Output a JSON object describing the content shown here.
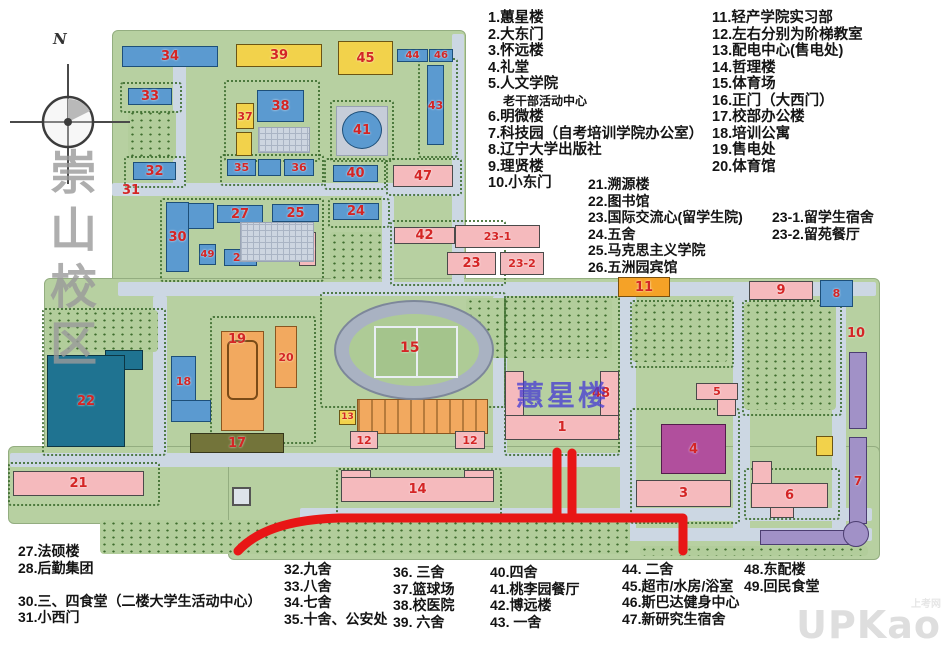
{
  "campus_label": "崇山校区",
  "compass_n": "N",
  "overlay": {
    "building_highlight": "蕙星楼",
    "route_color": "#e81616"
  },
  "watermark": {
    "main": "UPKao",
    "sub": "上考网"
  },
  "legend": {
    "tl": [
      "1.蕙星楼",
      "2.大东门",
      "3.怀远楼",
      "4.礼堂",
      "5.人文学院",
      "老干部活动中心",
      "6.明微楼",
      "7.科技园（自考培训学院办公室）",
      "8.辽宁大学出版社",
      "9.理贤楼",
      "10.小东门"
    ],
    "tr": [
      "11.轻产学院实习部",
      "12.左右分别为阶梯教室",
      "13.配电中心(售电处)",
      "14.哲理楼",
      "15.体育场",
      "16.正门（大西门）",
      "17.校部办公楼",
      "18.培训公寓",
      "19.售电处",
      "20.体育馆"
    ],
    "mid": [
      "21.溯源楼",
      "22.图书馆",
      "23.国际交流心(留学生院)",
      "24.五舍",
      "25.马克思主义学院",
      "26.五洲园宾馆"
    ],
    "mid2": [
      "23-1.留学生宿舍",
      "23-2.留苑餐厅"
    ],
    "b1": [
      "27.法硕楼",
      "28.后勤集团",
      "",
      "30.三、四食堂（二楼大学生活动中心）",
      "31.小西门"
    ],
    "b2": [
      "32.九舍",
      "33.八舍",
      "34.七舍",
      "35.十舍、公安处"
    ],
    "b3": [
      "36. 三舍",
      "37.篮球场",
      "38.校医院",
      "39. 六舍"
    ],
    "b4": [
      "40.四舍",
      "41.桃李园餐厅",
      "42.博远楼",
      "43. 一舍"
    ],
    "b5": [
      "44. 二舍",
      "45.超市/水房/浴室",
      "46.斯巴达健身中心",
      "47.新研究生宿舍"
    ],
    "b6": [
      "48.东配楼",
      "49.回民食堂"
    ]
  },
  "map": {
    "base": [
      {
        "x": 112,
        "y": 30,
        "w": 352,
        "h": 262
      },
      {
        "x": 44,
        "y": 278,
        "w": 834,
        "h": 192
      },
      {
        "x": 8,
        "y": 446,
        "w": 222,
        "h": 76
      },
      {
        "x": 228,
        "y": 446,
        "w": 650,
        "h": 112
      }
    ],
    "roads": [
      {
        "x": 112,
        "y": 183,
        "w": 350,
        "h": 13
      },
      {
        "x": 173,
        "y": 58,
        "w": 13,
        "h": 138
      },
      {
        "x": 452,
        "y": 34,
        "w": 12,
        "h": 258
      },
      {
        "x": 118,
        "y": 282,
        "w": 758,
        "h": 14
      },
      {
        "x": 153,
        "y": 296,
        "w": 14,
        "h": 166
      },
      {
        "x": 382,
        "y": 196,
        "w": 12,
        "h": 92
      },
      {
        "x": 493,
        "y": 296,
        "w": 14,
        "h": 166
      },
      {
        "x": 620,
        "y": 296,
        "w": 16,
        "h": 240
      },
      {
        "x": 733,
        "y": 296,
        "w": 17,
        "h": 236
      },
      {
        "x": 832,
        "y": 296,
        "w": 14,
        "h": 236
      },
      {
        "x": 10,
        "y": 453,
        "w": 612,
        "h": 14
      },
      {
        "x": 300,
        "y": 508,
        "w": 572,
        "h": 13
      },
      {
        "x": 618,
        "y": 528,
        "w": 254,
        "h": 13
      }
    ],
    "parks": [
      {
        "x": 466,
        "y": 298,
        "w": 146,
        "h": 60
      },
      {
        "x": 632,
        "y": 302,
        "w": 96,
        "h": 60
      },
      {
        "x": 744,
        "y": 302,
        "w": 92,
        "h": 108
      },
      {
        "x": 128,
        "y": 110,
        "w": 48,
        "h": 50
      },
      {
        "x": 330,
        "y": 232,
        "w": 52,
        "h": 48
      },
      {
        "x": 100,
        "y": 520,
        "w": 530,
        "h": 34
      },
      {
        "x": 640,
        "y": 546,
        "w": 228,
        "h": 10
      },
      {
        "x": 46,
        "y": 310,
        "w": 112,
        "h": 42
      }
    ],
    "blocks": [
      {
        "x": 120,
        "y": 82,
        "w": 58,
        "h": 27
      },
      {
        "x": 224,
        "y": 80,
        "w": 92,
        "h": 78
      },
      {
        "x": 330,
        "y": 100,
        "w": 60,
        "h": 58
      },
      {
        "x": 418,
        "y": 58,
        "w": 36,
        "h": 96
      },
      {
        "x": 124,
        "y": 156,
        "w": 58,
        "h": 28
      },
      {
        "x": 220,
        "y": 154,
        "w": 100,
        "h": 28
      },
      {
        "x": 324,
        "y": 158,
        "w": 58,
        "h": 28
      },
      {
        "x": 386,
        "y": 158,
        "w": 72,
        "h": 34
      },
      {
        "x": 160,
        "y": 198,
        "w": 160,
        "h": 80
      },
      {
        "x": 328,
        "y": 198,
        "w": 58,
        "h": 26
      },
      {
        "x": 390,
        "y": 220,
        "w": 112,
        "h": 62
      },
      {
        "x": 320,
        "y": 292,
        "w": 182,
        "h": 112
      },
      {
        "x": 210,
        "y": 316,
        "w": 102,
        "h": 124
      },
      {
        "x": 42,
        "y": 308,
        "w": 120,
        "h": 144
      },
      {
        "x": 336,
        "y": 468,
        "w": 162,
        "h": 44
      },
      {
        "x": 8,
        "y": 462,
        "w": 148,
        "h": 40
      },
      {
        "x": 504,
        "y": 296,
        "w": 112,
        "h": 156
      },
      {
        "x": 630,
        "y": 300,
        "w": 100,
        "h": 64
      },
      {
        "x": 742,
        "y": 300,
        "w": 96,
        "h": 112
      },
      {
        "x": 630,
        "y": 408,
        "w": 106,
        "h": 112
      },
      {
        "x": 744,
        "y": 468,
        "w": 92,
        "h": 48
      }
    ],
    "buildings": [
      {
        "n": "34",
        "x": 122,
        "y": 46,
        "w": 96,
        "h": 21,
        "c": "blue"
      },
      {
        "n": "39",
        "x": 236,
        "y": 44,
        "w": 86,
        "h": 23,
        "c": "yellow"
      },
      {
        "n": "45",
        "x": 338,
        "y": 41,
        "w": 55,
        "h": 34,
        "c": "yellow"
      },
      {
        "n": "44",
        "x": 397,
        "y": 49,
        "w": 31,
        "h": 13,
        "c": "blue",
        "fs": 10
      },
      {
        "n": "46",
        "x": 429,
        "y": 49,
        "w": 24,
        "h": 13,
        "c": "blue",
        "fs": 10
      },
      {
        "n": "33",
        "x": 128,
        "y": 88,
        "w": 44,
        "h": 17,
        "c": "blue"
      },
      {
        "n": "37",
        "x": 236,
        "y": 103,
        "w": 18,
        "h": 26,
        "c": "yellow",
        "fs": 11
      },
      {
        "n": "38",
        "x": 257,
        "y": 90,
        "w": 47,
        "h": 32,
        "c": "blue"
      },
      {
        "x": 236,
        "y": 132,
        "w": 16,
        "h": 24,
        "c": "yellow"
      },
      {
        "x": 258,
        "y": 127,
        "w": 52,
        "h": 26,
        "c": "court"
      },
      {
        "n": "35",
        "x": 227,
        "y": 159,
        "w": 29,
        "h": 17,
        "c": "blue",
        "fs": 11
      },
      {
        "x": 258,
        "y": 159,
        "w": 23,
        "h": 17,
        "c": "blue"
      },
      {
        "n": "36",
        "x": 284,
        "y": 159,
        "w": 30,
        "h": 17,
        "c": "blue",
        "fs": 11
      },
      {
        "n": "32",
        "x": 133,
        "y": 162,
        "w": 43,
        "h": 18,
        "c": "blue"
      },
      {
        "x": 336,
        "y": 106,
        "w": 52,
        "h": 50,
        "c": "gray"
      },
      {
        "n": "41",
        "x": 342,
        "y": 111,
        "w": 40,
        "h": 38,
        "c": "blue",
        "r": "50%"
      },
      {
        "n": "43",
        "x": 427,
        "y": 65,
        "w": 17,
        "h": 80,
        "c": "blue",
        "fs": 11
      },
      {
        "n": "40",
        "x": 333,
        "y": 165,
        "w": 45,
        "h": 17,
        "c": "blue"
      },
      {
        "n": "47",
        "x": 393,
        "y": 165,
        "w": 60,
        "h": 22,
        "c": "pink"
      },
      {
        "n": "30",
        "x": 166,
        "y": 202,
        "w": 23,
        "h": 70,
        "c": "blue"
      },
      {
        "x": 188,
        "y": 203,
        "w": 26,
        "h": 26,
        "c": "blue"
      },
      {
        "n": "27",
        "x": 217,
        "y": 205,
        "w": 46,
        "h": 18,
        "c": "blue"
      },
      {
        "n": "25",
        "x": 272,
        "y": 204,
        "w": 47,
        "h": 18,
        "c": "blue"
      },
      {
        "n": "24",
        "x": 333,
        "y": 203,
        "w": 46,
        "h": 17,
        "c": "blue"
      },
      {
        "n": "49",
        "x": 199,
        "y": 244,
        "w": 17,
        "h": 21,
        "c": "blue",
        "fs": 10
      },
      {
        "n": "28",
        "x": 224,
        "y": 249,
        "w": 33,
        "h": 17,
        "c": "blue",
        "fs": 11
      },
      {
        "n": "26",
        "x": 299,
        "y": 232,
        "w": 17,
        "h": 34,
        "c": "pink",
        "fs": 10
      },
      {
        "x": 240,
        "y": 222,
        "w": 74,
        "h": 40,
        "c": "court"
      },
      {
        "n": "42",
        "x": 394,
        "y": 227,
        "w": 61,
        "h": 17,
        "c": "pink"
      },
      {
        "n": "23-1",
        "x": 455,
        "y": 225,
        "w": 85,
        "h": 23,
        "c": "pink",
        "fs": 11
      },
      {
        "n": "23",
        "x": 447,
        "y": 252,
        "w": 49,
        "h": 23,
        "c": "pink"
      },
      {
        "n": "23-2",
        "x": 500,
        "y": 252,
        "w": 44,
        "h": 23,
        "c": "pink",
        "fs": 11
      },
      {
        "n": "11",
        "x": 618,
        "y": 277,
        "w": 52,
        "h": 20,
        "c": "orange2"
      },
      {
        "n": "9",
        "x": 749,
        "y": 281,
        "w": 64,
        "h": 19,
        "c": "pink"
      },
      {
        "n": "8",
        "x": 820,
        "y": 280,
        "w": 33,
        "h": 27,
        "c": "blue",
        "fs": 11
      },
      {
        "x": 105,
        "y": 350,
        "w": 38,
        "h": 20,
        "c": "teal"
      },
      {
        "n": "22",
        "x": 47,
        "y": 355,
        "w": 78,
        "h": 92,
        "c": "teal"
      },
      {
        "n": "18",
        "x": 171,
        "y": 356,
        "w": 25,
        "h": 50,
        "c": "blue",
        "fs": 11
      },
      {
        "x": 171,
        "y": 400,
        "w": 40,
        "h": 22,
        "c": "blue"
      },
      {
        "x": 221,
        "y": 331,
        "w": 43,
        "h": 100,
        "c": "orange",
        "k": "hall"
      },
      {
        "n": "20",
        "x": 275,
        "y": 326,
        "w": 22,
        "h": 62,
        "c": "orange",
        "fs": 11
      },
      {
        "n": "17",
        "x": 190,
        "y": 433,
        "w": 94,
        "h": 20,
        "c": "olive"
      },
      {
        "n": "13",
        "x": 339,
        "y": 410,
        "w": 17,
        "h": 15,
        "c": "yellow",
        "fs": 9
      },
      {
        "x": 357,
        "y": 399,
        "w": 131,
        "h": 35,
        "c": "orange",
        "k": "arcade"
      },
      {
        "n": "12",
        "x": 350,
        "y": 431,
        "w": 28,
        "h": 18,
        "c": "pink",
        "fs": 11
      },
      {
        "n": "12",
        "x": 455,
        "y": 431,
        "w": 30,
        "h": 18,
        "c": "pink",
        "fs": 11
      },
      {
        "x": 341,
        "y": 470,
        "w": 30,
        "h": 12,
        "c": "pink"
      },
      {
        "x": 464,
        "y": 470,
        "w": 30,
        "h": 12,
        "c": "pink"
      },
      {
        "n": "14",
        "x": 341,
        "y": 477,
        "w": 153,
        "h": 25,
        "c": "pink"
      },
      {
        "n": "21",
        "x": 13,
        "y": 471,
        "w": 131,
        "h": 25,
        "c": "pink"
      },
      {
        "x": 505,
        "y": 371,
        "w": 19,
        "h": 47,
        "c": "pink"
      },
      {
        "x": 600,
        "y": 371,
        "w": 19,
        "h": 47,
        "c": "pink"
      },
      {
        "n": "1",
        "x": 505,
        "y": 415,
        "w": 114,
        "h": 25,
        "c": "pink"
      },
      {
        "n": "5",
        "x": 696,
        "y": 383,
        "w": 42,
        "h": 17,
        "c": "pink",
        "fs": 11
      },
      {
        "x": 717,
        "y": 399,
        "w": 19,
        "h": 17,
        "c": "pink"
      },
      {
        "n": "4",
        "x": 661,
        "y": 424,
        "w": 65,
        "h": 50,
        "c": "magenta"
      },
      {
        "n": "3",
        "x": 636,
        "y": 480,
        "w": 95,
        "h": 27,
        "c": "pink"
      },
      {
        "x": 752,
        "y": 461,
        "w": 20,
        "h": 23,
        "c": "pink"
      },
      {
        "n": "6",
        "x": 751,
        "y": 483,
        "w": 77,
        "h": 25,
        "c": "pink"
      },
      {
        "x": 770,
        "y": 507,
        "w": 24,
        "h": 11,
        "c": "pink"
      },
      {
        "x": 849,
        "y": 352,
        "w": 18,
        "h": 77,
        "c": "purple"
      },
      {
        "n": "7",
        "x": 849,
        "y": 437,
        "w": 18,
        "h": 87,
        "c": "purple",
        "fs": 12
      },
      {
        "x": 760,
        "y": 530,
        "w": 92,
        "h": 15,
        "c": "purple"
      },
      {
        "x": 843,
        "y": 521,
        "w": 26,
        "h": 26,
        "c": "purple",
        "r": "50%"
      },
      {
        "x": 816,
        "y": 436,
        "w": 17,
        "h": 20,
        "c": "yellow"
      },
      {
        "x": 232,
        "y": 487,
        "w": 19,
        "h": 19,
        "c": "monument"
      }
    ],
    "labels": [
      {
        "t": "31",
        "x": 122,
        "y": 183
      },
      {
        "t": "10",
        "x": 847,
        "y": 326
      },
      {
        "t": "48",
        "x": 592,
        "y": 386
      },
      {
        "t": "19",
        "x": 228,
        "y": 332
      },
      {
        "t": "15",
        "x": 400,
        "y": 340
      }
    ],
    "route": {
      "paths": [
        "M238,551 C260,527 300,519 340,518 L683,518 L683,551",
        "M557,517 L557,452",
        "M572,517 L572,453"
      ]
    }
  }
}
